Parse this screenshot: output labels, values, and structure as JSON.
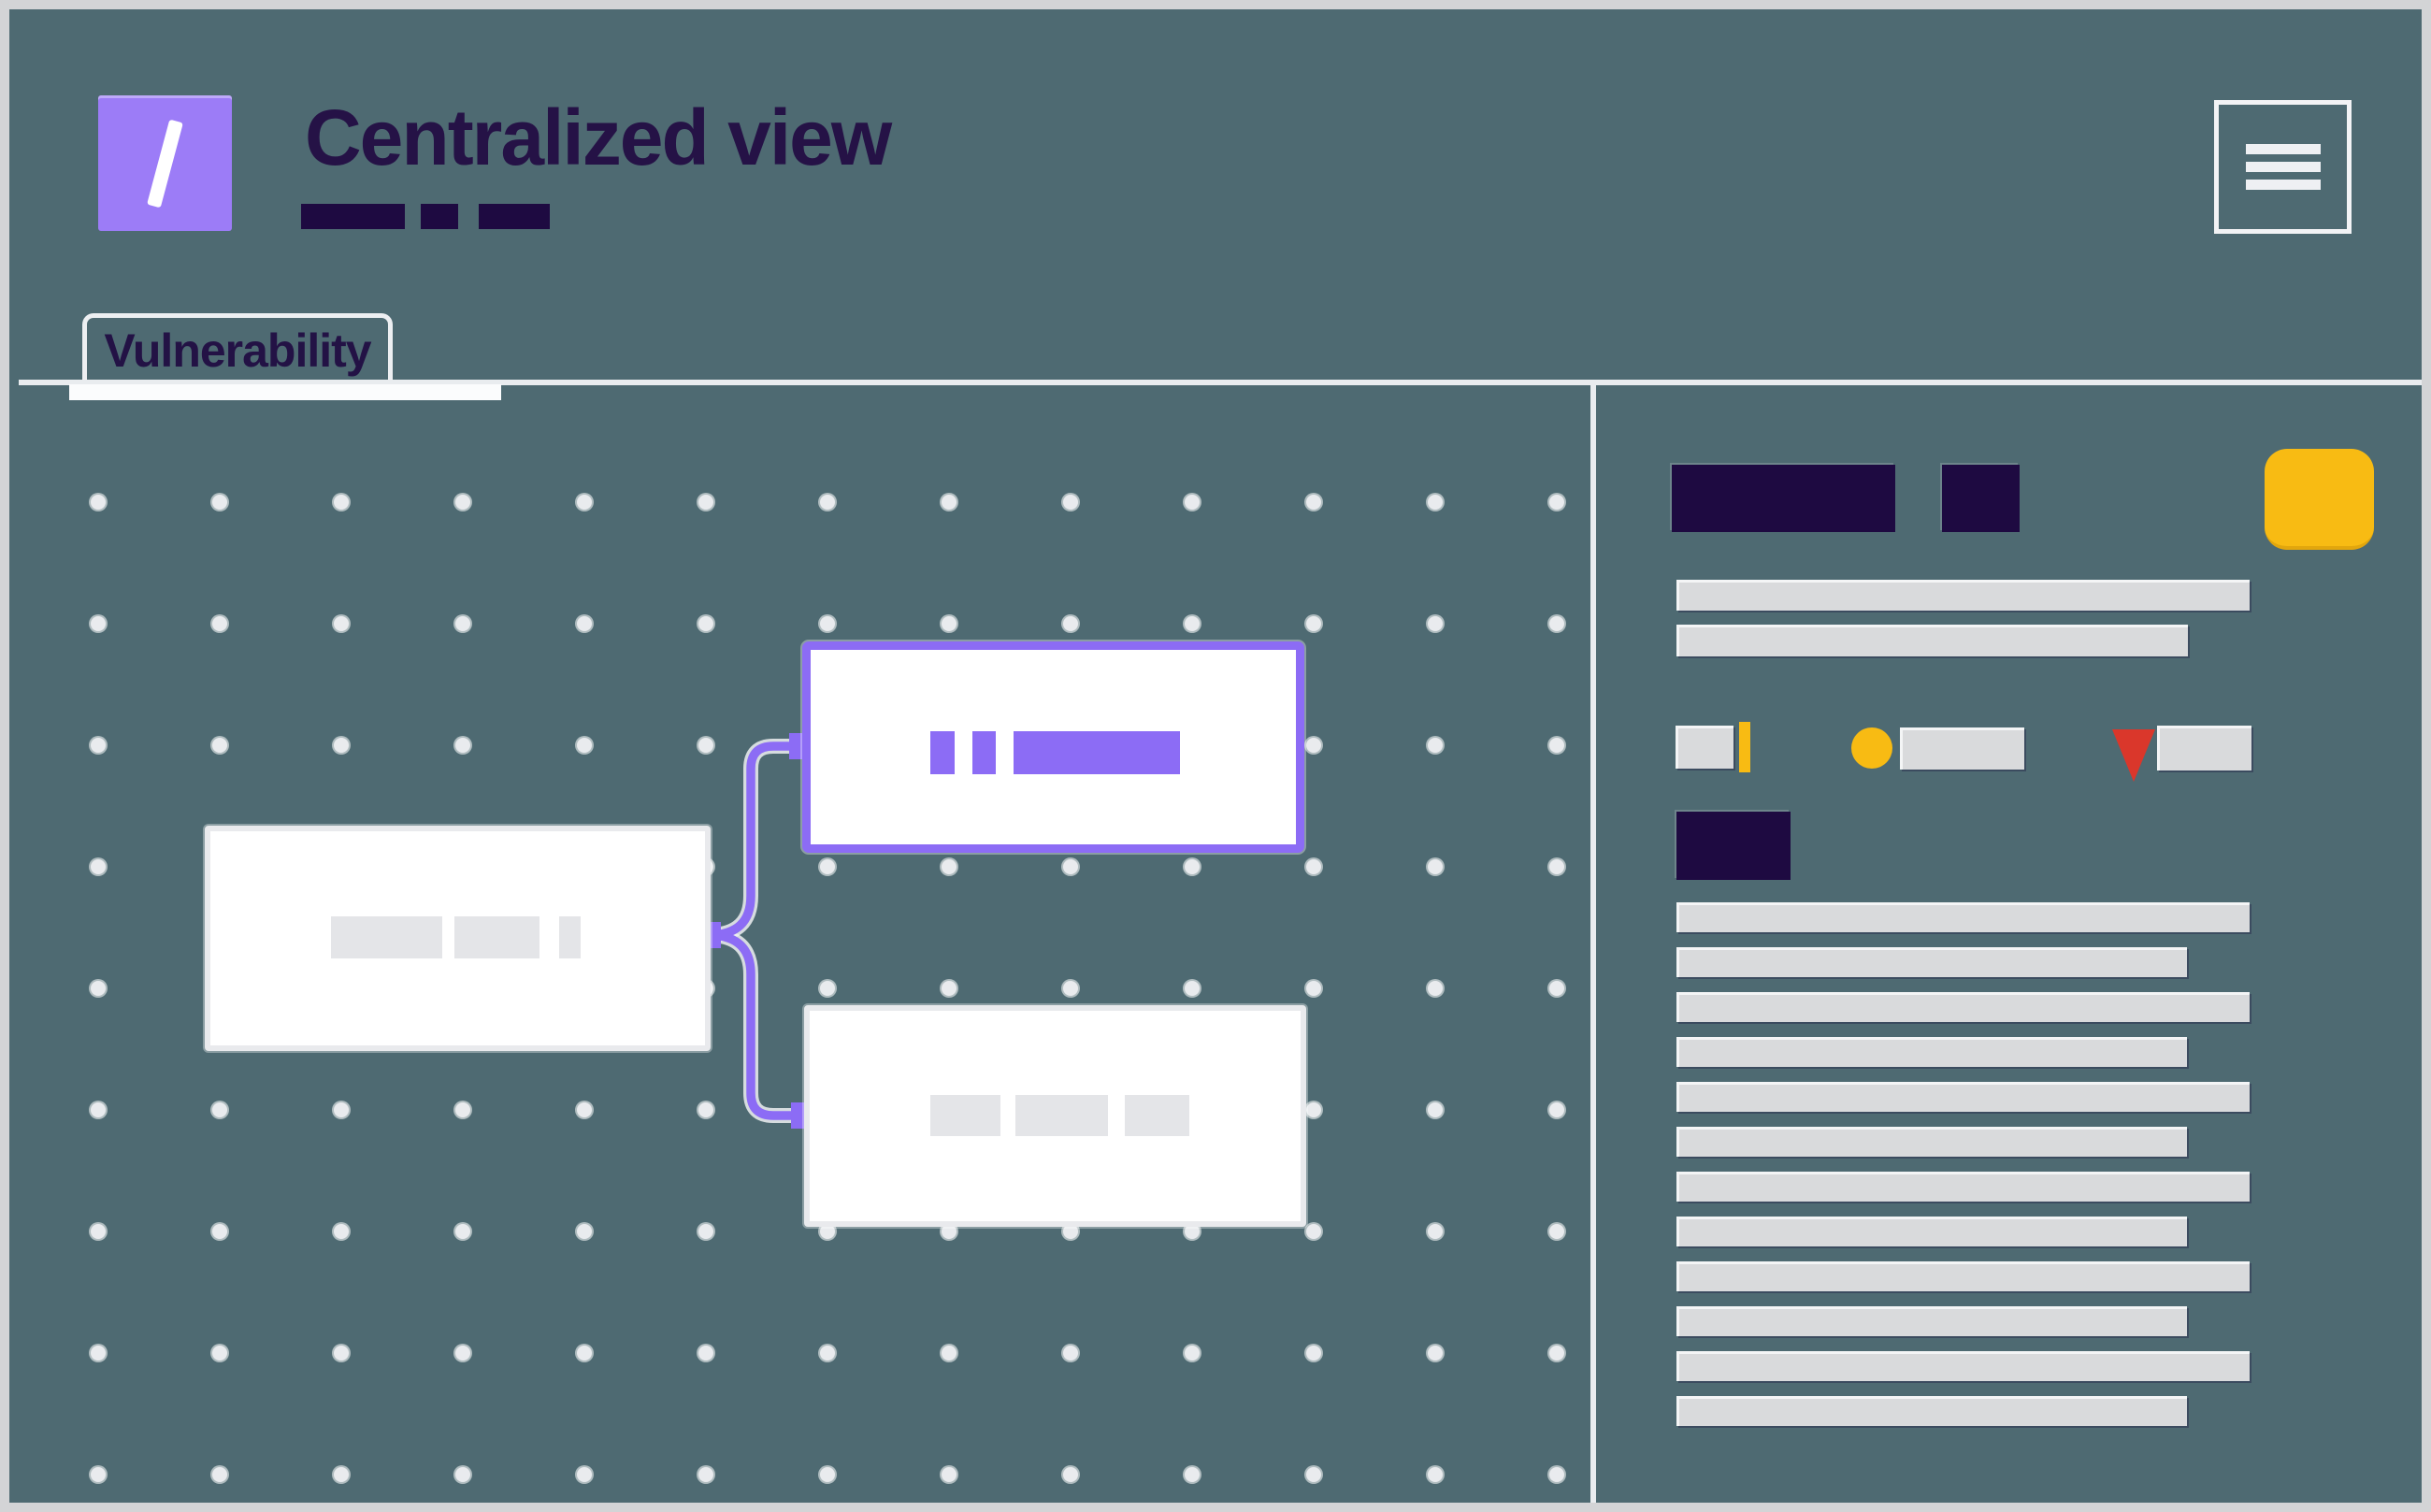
{
  "app": {
    "title": "Centralized view",
    "logo_glyph": "/"
  },
  "nav": {
    "active_tab": "Vulnerability"
  },
  "colors": {
    "background": "#4e6a72",
    "frame_border": "#d3d4d6",
    "accent_purple": "#8c6cf5",
    "logo_purple": "#9c7cf7",
    "dark_navy": "#1e0a41",
    "title_navy": "#251246",
    "yellow": "#f8bb13",
    "red": "#da372b",
    "skeleton_gray": "#d9dadc",
    "node_skeleton_gray": "#e4e5e8",
    "white": "#ffffff"
  },
  "diagram": {
    "nodes": [
      {
        "id": "source-node",
        "selected": false,
        "skeleton_blocks": 3
      },
      {
        "id": "target-node-top",
        "selected": true,
        "skeleton_blocks": 3
      },
      {
        "id": "target-node-bottom",
        "selected": false,
        "skeleton_blocks": 3
      }
    ],
    "edges": [
      {
        "from": "source-node",
        "to": "target-node-top"
      },
      {
        "from": "source-node",
        "to": "target-node-bottom"
      }
    ]
  },
  "panel": {
    "header_skeleton_blocks": 2,
    "intro_bars": [
      "long",
      "short"
    ],
    "legend": [
      {
        "marker": "yellow-bar"
      },
      {
        "marker": "yellow-circle"
      },
      {
        "marker": "red-triangle"
      }
    ],
    "section_block": 1,
    "list_bars": [
      "long",
      "short",
      "long",
      "short",
      "long",
      "short",
      "long",
      "short",
      "long",
      "short",
      "long",
      "short"
    ]
  }
}
